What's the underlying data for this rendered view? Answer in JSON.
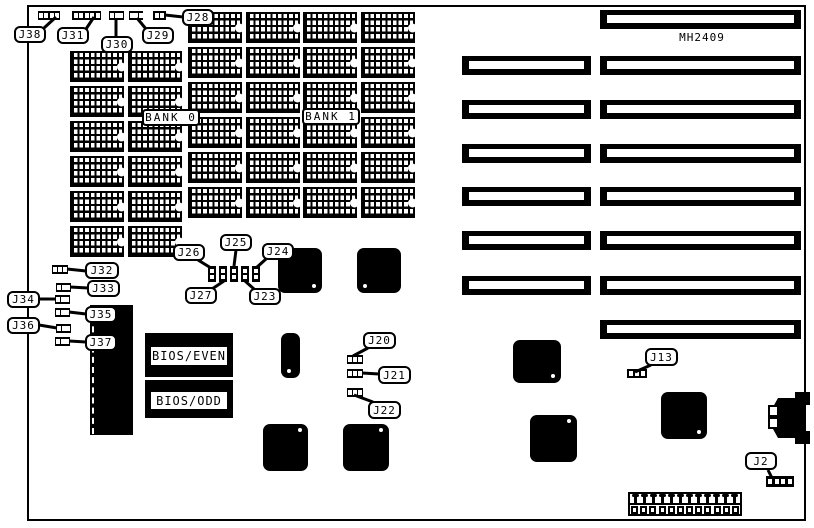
{
  "board": {
    "title": "MH2409",
    "ink": "#000000",
    "background": "#ffffff"
  },
  "memory": {
    "bank0_label": "BANK 0",
    "bank1_label": "BANK 1",
    "columns": 6,
    "chips_per_column": 6
  },
  "bios": {
    "even_label": "BIOS/EVEN",
    "odd_label": "BIOS/ODD"
  },
  "jumper_labels": {
    "j38": "J38",
    "j31": "J31",
    "j30": "J30",
    "j29": "J29",
    "j28": "J28",
    "j32": "J32",
    "j33": "J33",
    "j34": "J34",
    "j35": "J35",
    "j36": "J36",
    "j37": "J37",
    "j26": "J26",
    "j25": "J25",
    "j24": "J24",
    "j27": "J27",
    "j23": "J23",
    "j20": "J20",
    "j21": "J21",
    "j22": "J22",
    "j13": "J13",
    "j2": "J2"
  },
  "power_connector": {
    "pins": 12
  }
}
